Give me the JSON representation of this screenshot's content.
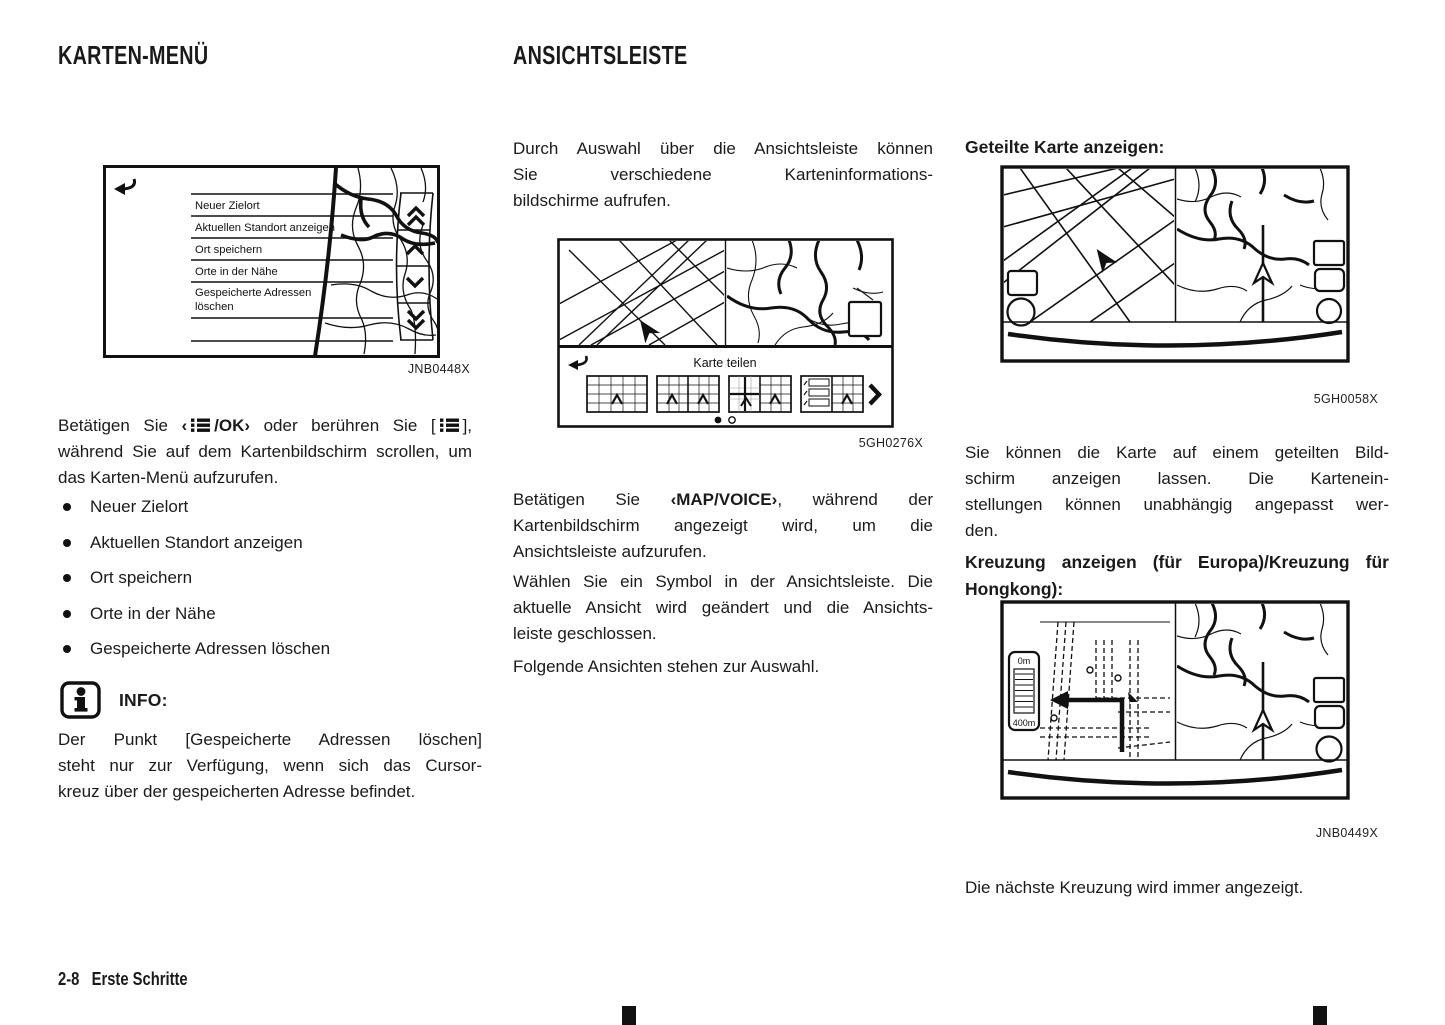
{
  "left": {
    "heading": "KARTEN-MENÜ",
    "fig_map_menu": {
      "caption": "JNB0448X",
      "items": [
        "Neuer Zielort",
        "Aktuellen Standort anzeigen",
        "Ort speichern",
        "Orte in der Nähe",
        "Gespeicherte Adressen",
        "löschen"
      ]
    },
    "p_intro": {
      "s1": "Betätigen Sie ",
      "s2": "‹",
      "s3": "/OK›",
      "s4": " oder berühren Sie [",
      "s5": "], während Sie auf dem Kartenbildschirm scrollen, um das Karten-Menü aufzurufen."
    },
    "bullets": [
      "Neuer Zielort",
      "Aktuellen Standort anzeigen",
      "Ort speichern",
      "Orte in der Nähe",
      "Gespeicherte Adressen löschen"
    ],
    "info": {
      "label": "INFO:",
      "lines": [
        "Der Punkt [Gespeicherte Adressen löschen]",
        "steht nur zur Verfügung, wenn sich das Cursor-",
        "kreuz über der gespeicherten Adresse befindet."
      ]
    }
  },
  "middle": {
    "heading": "ANSICHTSLEISTE",
    "p1": {
      "lines": [
        "Durch Auswahl über die Ansichtsleiste können",
        "Sie verschiedene Karteninformations-",
        "bildschirme aufrufen."
      ]
    },
    "fig_view_bar": {
      "caption": "5GH0276X",
      "title": "Karte teilen"
    },
    "p2": {
      "l1a": "Betätigen Sie ",
      "l1b": "‹MAP/VOICE›",
      "l1c": ", während der",
      "l2": "Kartenbildschirm angezeigt wird, um die",
      "l3": "Ansichtsleiste aufzurufen."
    },
    "p3": {
      "lines": [
        "Wählen Sie ein Symbol in der Ansichtsleiste. Die",
        "aktuelle Ansicht wird geändert und die Ansichts-",
        "leiste geschlossen."
      ]
    },
    "p4": "Folgende Ansichten stehen zur Auswahl."
  },
  "right": {
    "h_split": "Geteilte Karte anzeigen:",
    "fig_split_map": {
      "caption": "5GH0058X"
    },
    "p1": {
      "lines": [
        "Sie können die Karte auf einem geteilten Bild-",
        "schirm anzeigen lassen. Die Kartenein-",
        "stellungen können unabhängig angepasst wer-",
        "den."
      ]
    },
    "h_junction": {
      "lines": [
        "Kreuzung anzeigen (für Europa)/Kreuzung für",
        "Hongkong):"
      ]
    },
    "fig_junction": {
      "caption": "JNB0449X",
      "scale_top": "0m",
      "scale_bottom": "400m"
    },
    "p2": "Die nächste Kreuzung wird immer angezeigt."
  },
  "footer": {
    "page_number": "2-8",
    "section": "Erste Schritte"
  }
}
